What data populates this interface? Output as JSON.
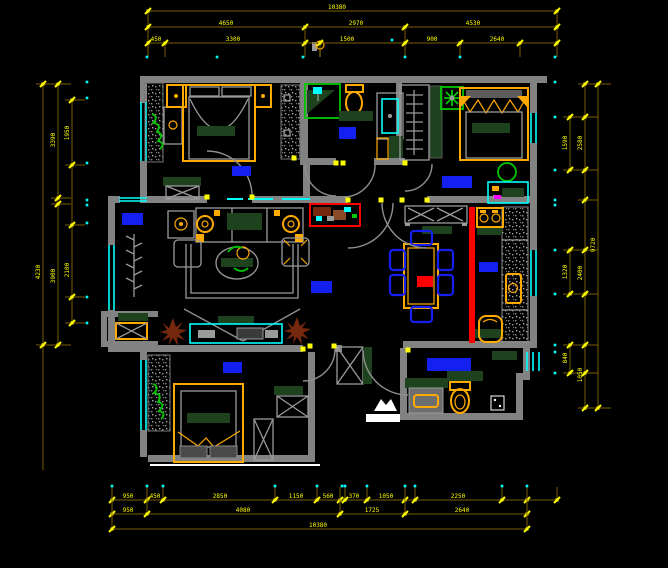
{
  "app": {
    "view": "cad-floorplan-drawing"
  },
  "palette": {
    "bg": "#000000",
    "wall": "#828282",
    "furniture_line": "#9a9a9a",
    "dim_line": "#7d5e00",
    "dim_tick": "#ffff00",
    "dim_text": "#ffff00",
    "datum_dot": "#00ffff",
    "window": "#00ffff",
    "plant_green": "#00c800",
    "dark_green": "#1e421e",
    "accent_orange": "#ffaa00",
    "label_blue": "#1420f0",
    "alert_red": "#ff0000",
    "plant_brown": "#76280e"
  },
  "dimensions": {
    "h_rows": [
      {
        "name": "top-total",
        "y": 11,
        "x1": 148,
        "x2": 557,
        "ext_to": 57,
        "ticks": [
          148,
          557
        ],
        "labels": [
          {
            "x": 337,
            "t": "10380"
          }
        ]
      },
      {
        "name": "top-major",
        "y": 27,
        "x1": 148,
        "x2": 557,
        "ext_to": 57,
        "ticks": [
          148,
          305,
          405,
          557
        ],
        "labels": [
          {
            "x": 226,
            "t": "4650"
          },
          {
            "x": 356,
            "t": "2970"
          },
          {
            "x": 473,
            "t": "4530"
          }
        ]
      },
      {
        "name": "top-minor",
        "y": 43,
        "x1": 148,
        "x2": 557,
        "ext_to": 57,
        "ticks": [
          148,
          165,
          305,
          320,
          405,
          460,
          520,
          557
        ],
        "labels": [
          {
            "x": 156,
            "t": "450"
          },
          {
            "x": 233,
            "t": "3300"
          },
          {
            "x": 347,
            "t": "1500"
          },
          {
            "x": 432,
            "t": "900"
          },
          {
            "x": 497,
            "t": "2640"
          }
        ]
      },
      {
        "name": "bottom-minor",
        "y": 500,
        "x1": 112,
        "x2": 557,
        "ext_to": 487,
        "ticks": [
          112,
          147,
          163,
          275,
          317,
          340,
          345,
          367,
          405,
          415,
          502,
          527,
          557
        ],
        "labels": [
          {
            "x": 128,
            "t": "950"
          },
          {
            "x": 155,
            "t": "450"
          },
          {
            "x": 220,
            "t": "2850"
          },
          {
            "x": 296,
            "t": "1150"
          },
          {
            "x": 328,
            "t": "560"
          },
          {
            "x": 354,
            "t": "370"
          },
          {
            "x": 386,
            "t": "1050"
          },
          {
            "x": 458,
            "t": "2250"
          }
        ]
      },
      {
        "name": "bottom-major",
        "y": 514,
        "x1": 112,
        "x2": 527,
        "ext_to": 487,
        "ticks": [
          112,
          147,
          340,
          405,
          527
        ],
        "labels": [
          {
            "x": 128,
            "t": "950"
          },
          {
            "x": 243,
            "t": "4080"
          },
          {
            "x": 372,
            "t": "1725"
          },
          {
            "x": 462,
            "t": "2640"
          }
        ]
      },
      {
        "name": "bottom-total",
        "y": 529,
        "x1": 112,
        "x2": 527,
        "ext_to": 487,
        "ticks": [
          112,
          527
        ],
        "labels": [
          {
            "x": 318,
            "t": "10380"
          }
        ]
      }
    ],
    "v_cols": [
      {
        "name": "left-total",
        "x": 43,
        "y1": 84,
        "y2": 470,
        "ticks": [
          84,
          345
        ],
        "labels": [
          {
            "y": 272,
            "t": "4230"
          }
        ]
      },
      {
        "name": "left-major",
        "x": 58,
        "y1": 84,
        "y2": 345,
        "ticks": [
          84,
          198,
          204,
          345
        ],
        "labels": [
          {
            "y": 140,
            "t": "3390"
          },
          {
            "y": 276,
            "t": "3900"
          }
        ]
      },
      {
        "name": "left-minor",
        "x": 72,
        "y1": 100,
        "y2": 323,
        "ticks": [
          100,
          165,
          225,
          297,
          323
        ],
        "labels": [
          {
            "y": 133,
            "t": "1950"
          },
          {
            "y": 270,
            "t": "2100"
          }
        ]
      },
      {
        "name": "right-seg-1",
        "x": 570,
        "y1": 117,
        "y2": 170,
        "ticks": [
          117,
          170
        ],
        "labels": [
          {
            "y": 143,
            "t": "1590"
          }
        ]
      },
      {
        "name": "right-seg-2",
        "x": 570,
        "y1": 250,
        "y2": 294,
        "ticks": [
          250,
          294
        ],
        "labels": [
          {
            "y": 272,
            "t": "1320"
          }
        ]
      },
      {
        "name": "right-seg-3",
        "x": 570,
        "y1": 345,
        "y2": 373,
        "ticks": [
          345,
          373
        ],
        "labels": [
          {
            "y": 358,
            "t": "840"
          }
        ]
      },
      {
        "name": "right-major",
        "x": 585,
        "y1": 84,
        "y2": 410,
        "ticks": [
          84,
          117,
          170,
          200,
          250,
          294,
          345,
          373,
          408
        ],
        "labels": [
          {
            "y": 143,
            "t": "2580"
          },
          {
            "y": 273,
            "t": "2400"
          },
          {
            "y": 375,
            "t": "1050"
          }
        ]
      },
      {
        "name": "right-total",
        "x": 598,
        "y1": 84,
        "y2": 410,
        "ticks": [
          84,
          408
        ],
        "labels": [
          {
            "y": 245,
            "t": "9720"
          }
        ]
      }
    ],
    "datum_dots": [
      [
        147,
        57
      ],
      [
        217,
        57
      ],
      [
        303,
        57
      ],
      [
        405,
        57
      ],
      [
        460,
        57
      ],
      [
        555,
        57
      ],
      [
        392,
        40
      ],
      [
        112,
        486
      ],
      [
        147,
        486
      ],
      [
        163,
        486
      ],
      [
        275,
        486
      ],
      [
        317,
        486
      ],
      [
        342,
        486
      ],
      [
        345,
        486
      ],
      [
        367,
        486
      ],
      [
        405,
        486
      ],
      [
        415,
        486
      ],
      [
        502,
        486
      ],
      [
        527,
        486
      ],
      [
        87,
        82
      ],
      [
        87,
        98
      ],
      [
        87,
        163
      ],
      [
        87,
        200
      ],
      [
        87,
        205
      ],
      [
        87,
        223
      ],
      [
        87,
        297
      ],
      [
        87,
        323
      ],
      [
        555,
        82
      ],
      [
        555,
        117
      ],
      [
        555,
        170
      ],
      [
        555,
        200
      ],
      [
        555,
        205
      ],
      [
        555,
        250
      ],
      [
        555,
        294
      ],
      [
        555,
        345
      ],
      [
        555,
        352
      ],
      [
        555,
        373
      ]
    ],
    "hinge_dots": [
      [
        207,
        197
      ],
      [
        252,
        197
      ],
      [
        294,
        158
      ],
      [
        303,
        349
      ],
      [
        334,
        346
      ],
      [
        336,
        163
      ],
      [
        343,
        163
      ],
      [
        405,
        163
      ],
      [
        348,
        200
      ],
      [
        381,
        200
      ],
      [
        402,
        200
      ],
      [
        427,
        200
      ],
      [
        408,
        350
      ],
      [
        310,
        346
      ]
    ]
  },
  "room_labels": [
    {
      "name": "bedroom1-label",
      "x": 232,
      "y": 166,
      "w": 19,
      "h": 10
    },
    {
      "name": "bathroom1-label",
      "x": 339,
      "y": 127,
      "w": 17,
      "h": 12
    },
    {
      "name": "bedroom2-label",
      "x": 442,
      "y": 176,
      "w": 30,
      "h": 12
    },
    {
      "name": "living-label",
      "x": 122,
      "y": 213,
      "w": 21,
      "h": 12
    },
    {
      "name": "dining-label",
      "x": 311,
      "y": 281,
      "w": 21,
      "h": 12
    },
    {
      "name": "kitchen-label",
      "x": 479,
      "y": 262,
      "w": 19,
      "h": 10
    },
    {
      "name": "bedroom3-label",
      "x": 223,
      "y": 362,
      "w": 19,
      "h": 11
    },
    {
      "name": "bathroom2-label",
      "x": 427,
      "y": 358,
      "w": 44,
      "h": 13
    }
  ]
}
